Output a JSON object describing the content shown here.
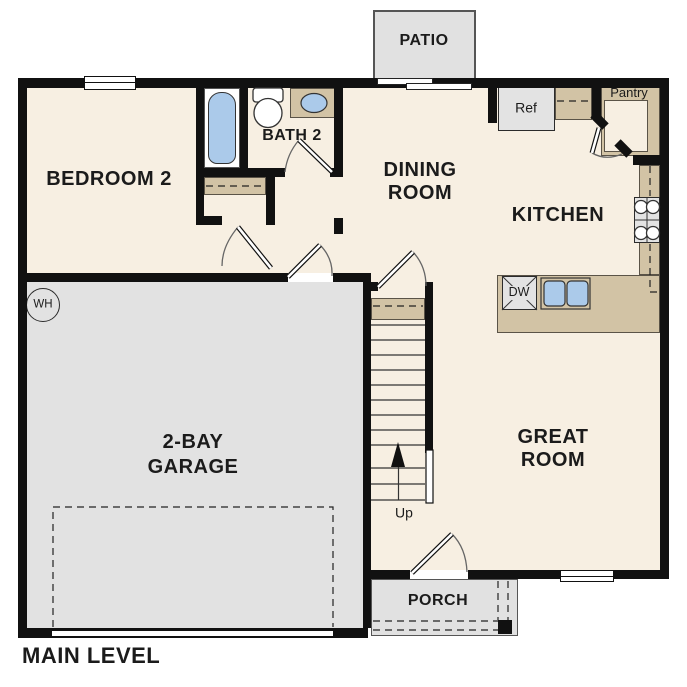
{
  "plan": {
    "title": "MAIN LEVEL",
    "rooms": {
      "bedroom2": "BEDROOM 2",
      "bath2": "BATH 2",
      "dining_line1": "DINING",
      "dining_line2": "ROOM",
      "kitchen": "KITCHEN",
      "great_line1": "GREAT",
      "great_line2": "ROOM",
      "garage_line1": "2-BAY",
      "garage_line2": "GARAGE",
      "patio": "PATIO",
      "porch": "PORCH",
      "pantry": "Pantry"
    },
    "fixtures": {
      "refrigerator": "Ref",
      "dishwasher": "DW",
      "water_heater": "WH",
      "stairs_up": "Up"
    },
    "colors": {
      "wall": "#111111",
      "floor": "#f7efe2",
      "garage": "#e2e2e2",
      "outdoor": "#e1e1e1",
      "counter": "#d2c3a5",
      "fixture_blue": "#abcaea",
      "appliance": "#e3e3e3"
    }
  }
}
